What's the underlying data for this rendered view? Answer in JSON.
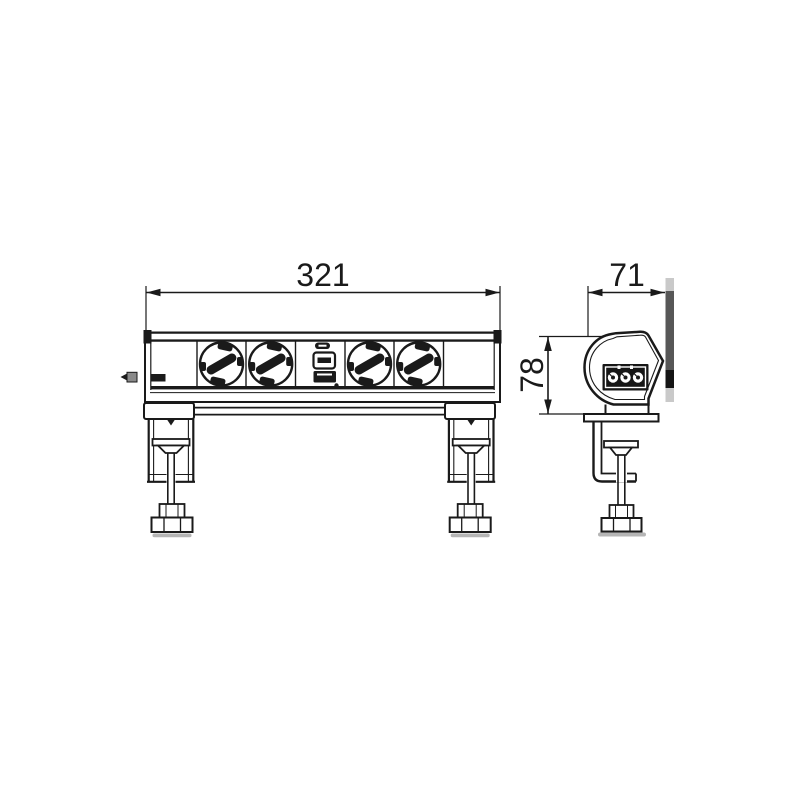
{
  "drawing": {
    "type": "technical-drawing",
    "subject": "Table-clamp mounted desk socket strip, front and side orthographic views",
    "dimensions": {
      "width": {
        "value": "321"
      },
      "depth": {
        "value": "71"
      },
      "height": {
        "value": "78"
      }
    },
    "front_view": {
      "modules": [
        "blank-panel",
        "schuko-socket",
        "schuko-socket",
        "usb-charger-module",
        "schuko-socket",
        "schuko-socket",
        "blank-panel"
      ],
      "socket_count": 4,
      "clamp_count": 2
    },
    "side_view": {
      "modules": [
        "power-connector-3pin"
      ],
      "clamp_count": 1
    },
    "colors": {
      "line": "#1a1a1a",
      "strip_light": "#c9c9c9",
      "strip_dark": "#575757",
      "strip_black": "#141414",
      "shadow": "#b5b5b5",
      "tab": "#8a8a8a"
    }
  }
}
